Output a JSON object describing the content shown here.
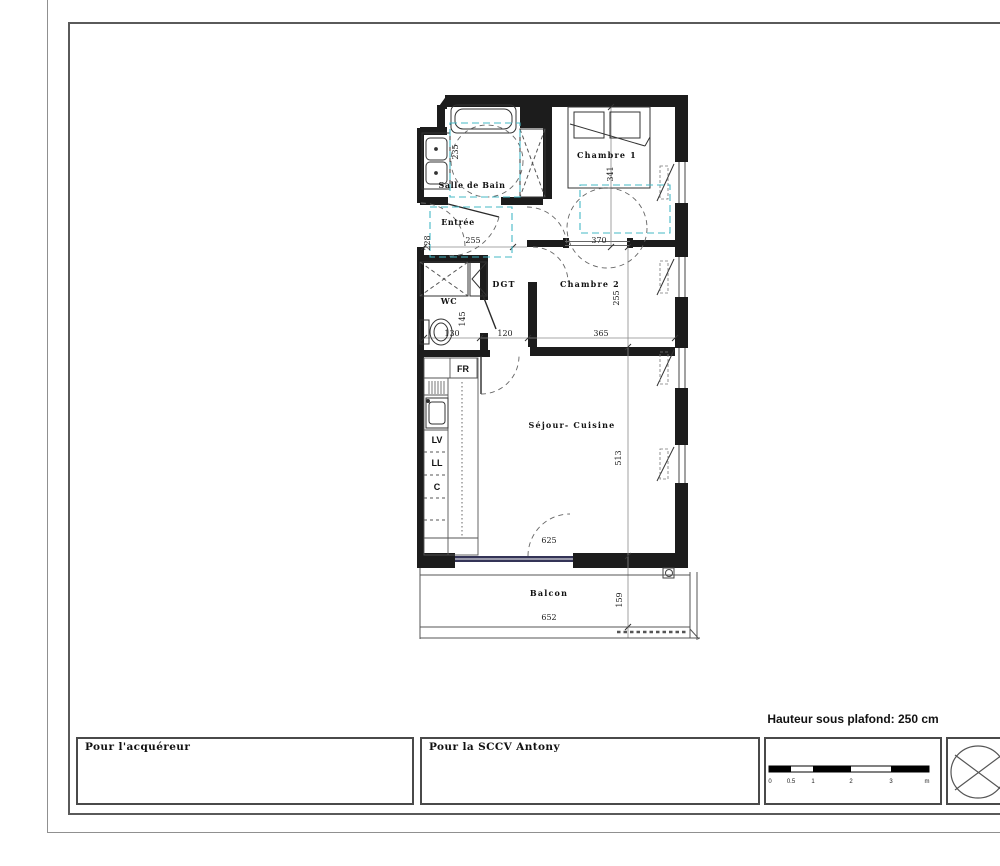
{
  "plan": {
    "rooms": {
      "salle_de_bain": "Salle de Bain",
      "entree": "Entrée",
      "wc": "WC",
      "dgt": "DGT",
      "chambre1": "Chambre 1",
      "chambre2": "Chambre 2",
      "sejour": "Séjour- Cuisine",
      "balcon": "Balcon"
    },
    "appliances": {
      "fr": "FR",
      "lv": "LV",
      "ll": "LL",
      "c": "C"
    },
    "dims": {
      "sdb_h": "235",
      "entree_w": "255",
      "entree_h": "228",
      "ch1_w": "370",
      "ch1_h": "341",
      "wc_h": "145",
      "wc_w": "130",
      "dgt_w": "120",
      "ch2_w": "365",
      "ch2_h": "255",
      "sejour_h": "513",
      "sejour_w": "625",
      "balcon_w": "652",
      "balcon_h": "159"
    }
  },
  "title_block": {
    "acquirer": "Pour l'acquéreur",
    "developer": "Pour la SCCV Antony",
    "ceiling": "Hauteur sous plafond: 250 cm",
    "scale_labels": [
      "0",
      "0.5",
      "1",
      "2",
      "3",
      "m"
    ]
  },
  "colors": {
    "wall": "#1c1c1c",
    "accessibility_zone": "#45b8c6",
    "glazing_bay": "#343457"
  }
}
